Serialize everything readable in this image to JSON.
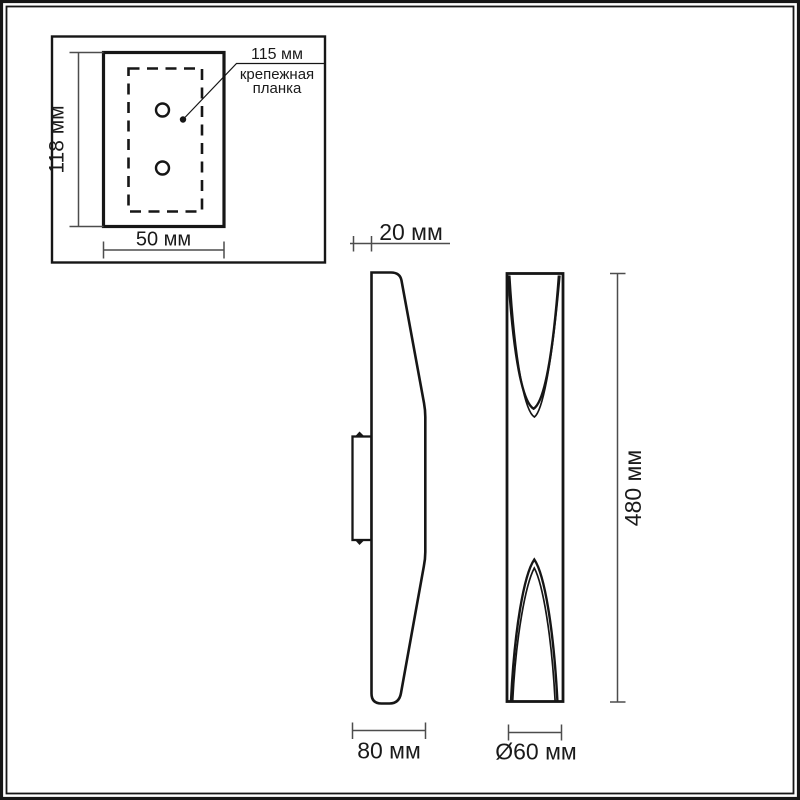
{
  "drawing": {
    "mount_plate_inset": {
      "height_label": "118 мм",
      "width_label": "50 мм",
      "hole_pitch_label": "115 мм",
      "part_name_line1": "крепежная",
      "part_name_line2": "планка"
    },
    "side_view": {
      "bracket_depth_label": "20 мм",
      "body_width_label": "80 мм"
    },
    "front_view": {
      "height_label": "480 мм",
      "diameter_label": "Ø60 мм"
    },
    "colors": {
      "line": "#161616",
      "dim_line": "#4d4d4d",
      "background": "#ffffff"
    }
  }
}
